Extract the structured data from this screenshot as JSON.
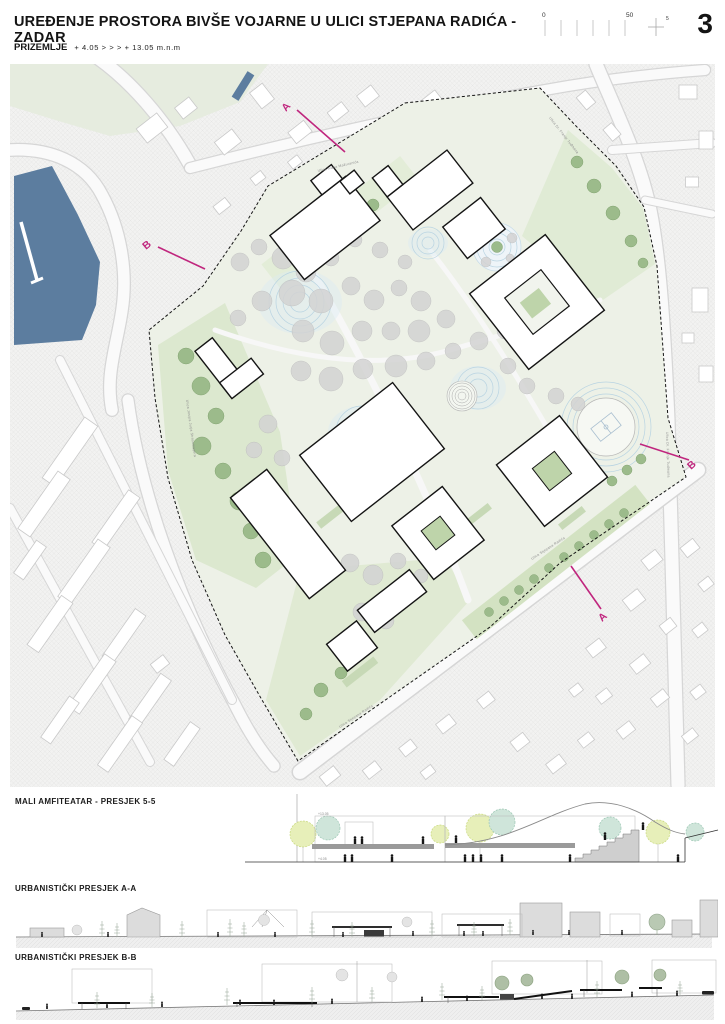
{
  "header": {
    "title": "UREĐENJE PROSTORA BIVŠE VOJARNE U ULICI STJEPANA RADIĆA - ZADAR",
    "page_number": "3",
    "scale_bar": {
      "zero": "0",
      "fifty": "50",
      "five": "5"
    }
  },
  "subtitle": {
    "level": "PRIZEMLJE",
    "range": "+ 4.05  > > >  + 13.05 m.n.m"
  },
  "plan": {
    "streets": {
      "mazuranica": "Ulica Ivana Mažuranića",
      "tudmana_top": "Ulica Dr. Franje Tuđmana",
      "tudmana_right": "Ulica Dr. Franje Tuđmana",
      "radica": "Ulica Stjepana Radića",
      "radica_lower": "Ulica Stjepana Radića",
      "strossmayera": "Ulica Josipa Jurja Strossmayera"
    },
    "markers": {
      "a": "A",
      "b": "B"
    },
    "colors": {
      "accent_magenta": "#c0267e",
      "water_blue": "#5c7d9f",
      "park_green": "#dfe9d2",
      "tree_green": "#9cbb8b",
      "canopy_gray": "#d3d3d3"
    }
  },
  "sections": {
    "amphitheater": {
      "title": "MALI AMFITEATAR - PRESJEK 5-5",
      "levels": [
        "+13.05",
        "+4.05"
      ]
    },
    "aa": {
      "title": "URBANISTIČKI PRESJEK A-A"
    },
    "bb": {
      "title": "URBANISTIČKI PRESJEK B-B"
    }
  }
}
